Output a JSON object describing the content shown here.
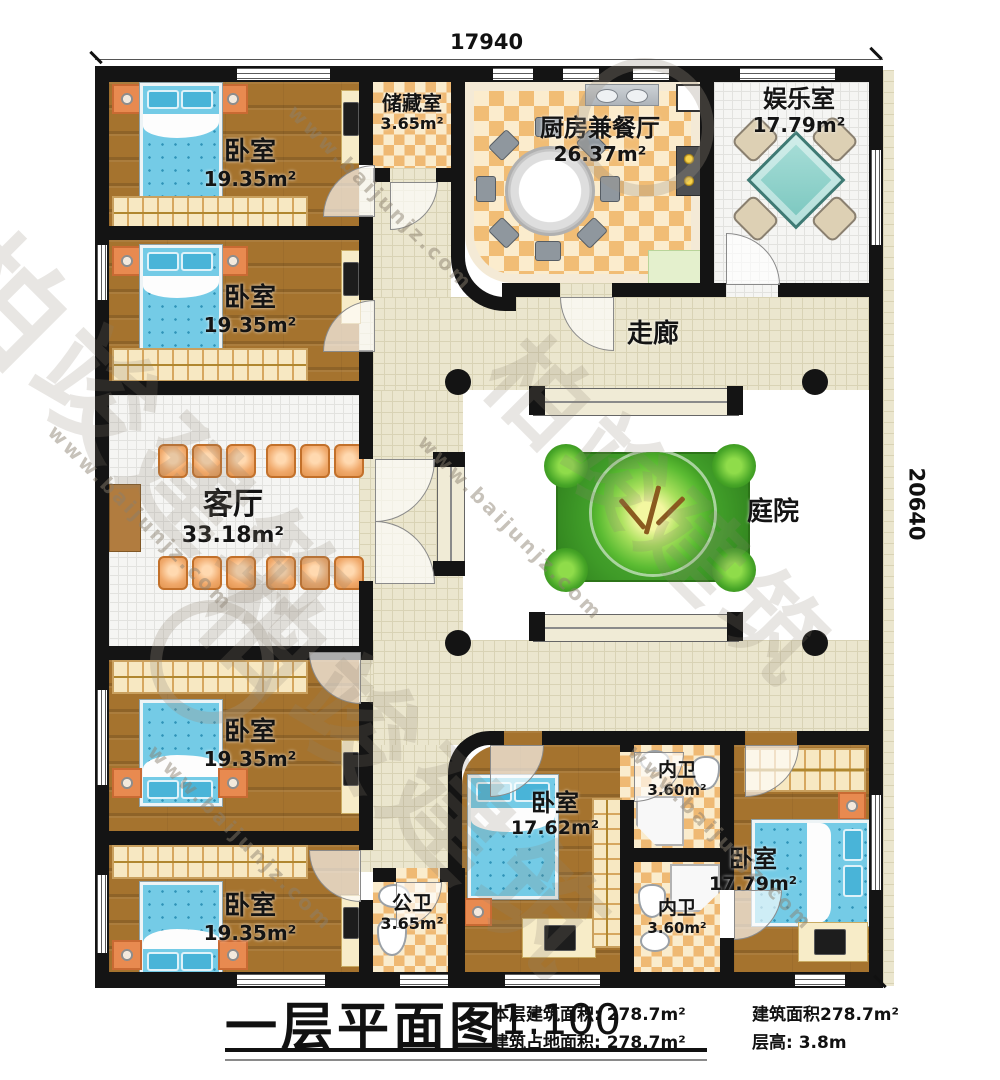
{
  "plan": {
    "dimensions": {
      "top": "17940",
      "right": "20640"
    },
    "rooms": {
      "bedroom_tl1": {
        "name": "卧室",
        "area": "19.35m²"
      },
      "bedroom_tl2": {
        "name": "卧室",
        "area": "19.35m²"
      },
      "storage": {
        "name": "储藏室",
        "area": "3.65m²"
      },
      "kitchen_dining": {
        "name": "厨房兼餐厅",
        "area": "26.37m²"
      },
      "entertainment": {
        "name": "娱乐室",
        "area": "17.79m²"
      },
      "corridor": {
        "name": "走廊"
      },
      "living_room": {
        "name": "客厅",
        "area": "33.18m²"
      },
      "courtyard": {
        "name": "庭院"
      },
      "bedroom_bl1": {
        "name": "卧室",
        "area": "19.35m²"
      },
      "bedroom_bl2": {
        "name": "卧室",
        "area": "19.35m²"
      },
      "public_bathroom": {
        "name": "公卫",
        "area": "3.65m²"
      },
      "bedroom_b_mid": {
        "name": "卧室",
        "area": "17.62m²"
      },
      "inner_bathroom_1": {
        "name": "内卫",
        "area": "3.60m²"
      },
      "inner_bathroom_2": {
        "name": "内卫",
        "area": "3.60m²"
      },
      "bedroom_br": {
        "name": "卧室",
        "area": "17.79m²"
      }
    }
  },
  "title_block": {
    "title": "一层平面图",
    "scale": "1:100",
    "info": [
      {
        "text": "本层建筑面积: 278.7m²"
      },
      {
        "text": "建筑面积278.7m²"
      },
      {
        "text": "建筑占地面积: 278.7m²"
      },
      {
        "text": "层高: 3.8m"
      }
    ]
  },
  "watermark": {
    "brand": "柏竣建筑",
    "url": "www.baijunjz.com"
  },
  "colors": {
    "wall": "#141414",
    "wood_floor": "#a5732e",
    "checker_tile": "#f1bd75",
    "corridor_tile": "#ebe6ce",
    "lawn": "#3f9b28",
    "bed_blue": "#74cbe6",
    "nightstand_orange": "#e88a50",
    "mahjong_teal": "#8fd2cb"
  }
}
